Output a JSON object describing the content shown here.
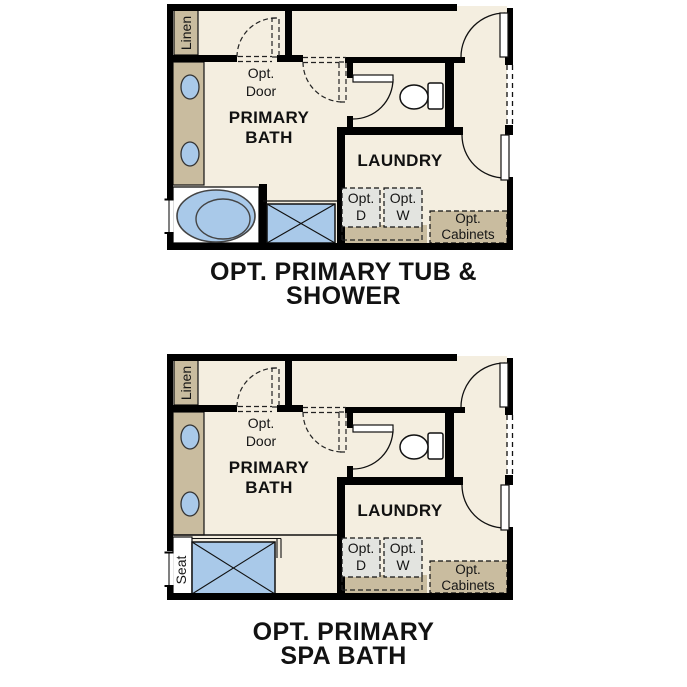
{
  "colors": {
    "floor": "#f4eee0",
    "tan": "#c9bc9f",
    "blue": "#a9c9e9",
    "gray": "#e3e4e0",
    "wall": "#000000"
  },
  "plans": [
    {
      "id": "tub-shower",
      "variant": "tub",
      "title": {
        "line1": "OPT. PRIMARY TUB &",
        "line2": "SHOWER"
      },
      "labels": {
        "linen": "Linen",
        "opt_door_l1": "Opt.",
        "opt_door_l2": "Door",
        "room_l1": "PRIMARY",
        "room_l2": "BATH",
        "laundry": "LAUNDRY",
        "opt_d_l1": "Opt.",
        "opt_d_l2": "D",
        "opt_w_l1": "Opt.",
        "opt_w_l2": "W",
        "opt_cab_l1": "Opt.",
        "opt_cab_l2": "Cabinets"
      }
    },
    {
      "id": "spa-bath",
      "variant": "spa",
      "title": {
        "line1": "OPT. PRIMARY",
        "line2": "SPA BATH"
      },
      "labels": {
        "linen": "Linen",
        "opt_door_l1": "Opt.",
        "opt_door_l2": "Door",
        "room_l1": "PRIMARY",
        "room_l2": "BATH",
        "laundry": "LAUNDRY",
        "opt_d_l1": "Opt.",
        "opt_d_l2": "D",
        "opt_w_l1": "Opt.",
        "opt_w_l2": "W",
        "opt_cab_l1": "Opt.",
        "opt_cab_l2": "Cabinets",
        "seat": "Seat"
      }
    }
  ]
}
